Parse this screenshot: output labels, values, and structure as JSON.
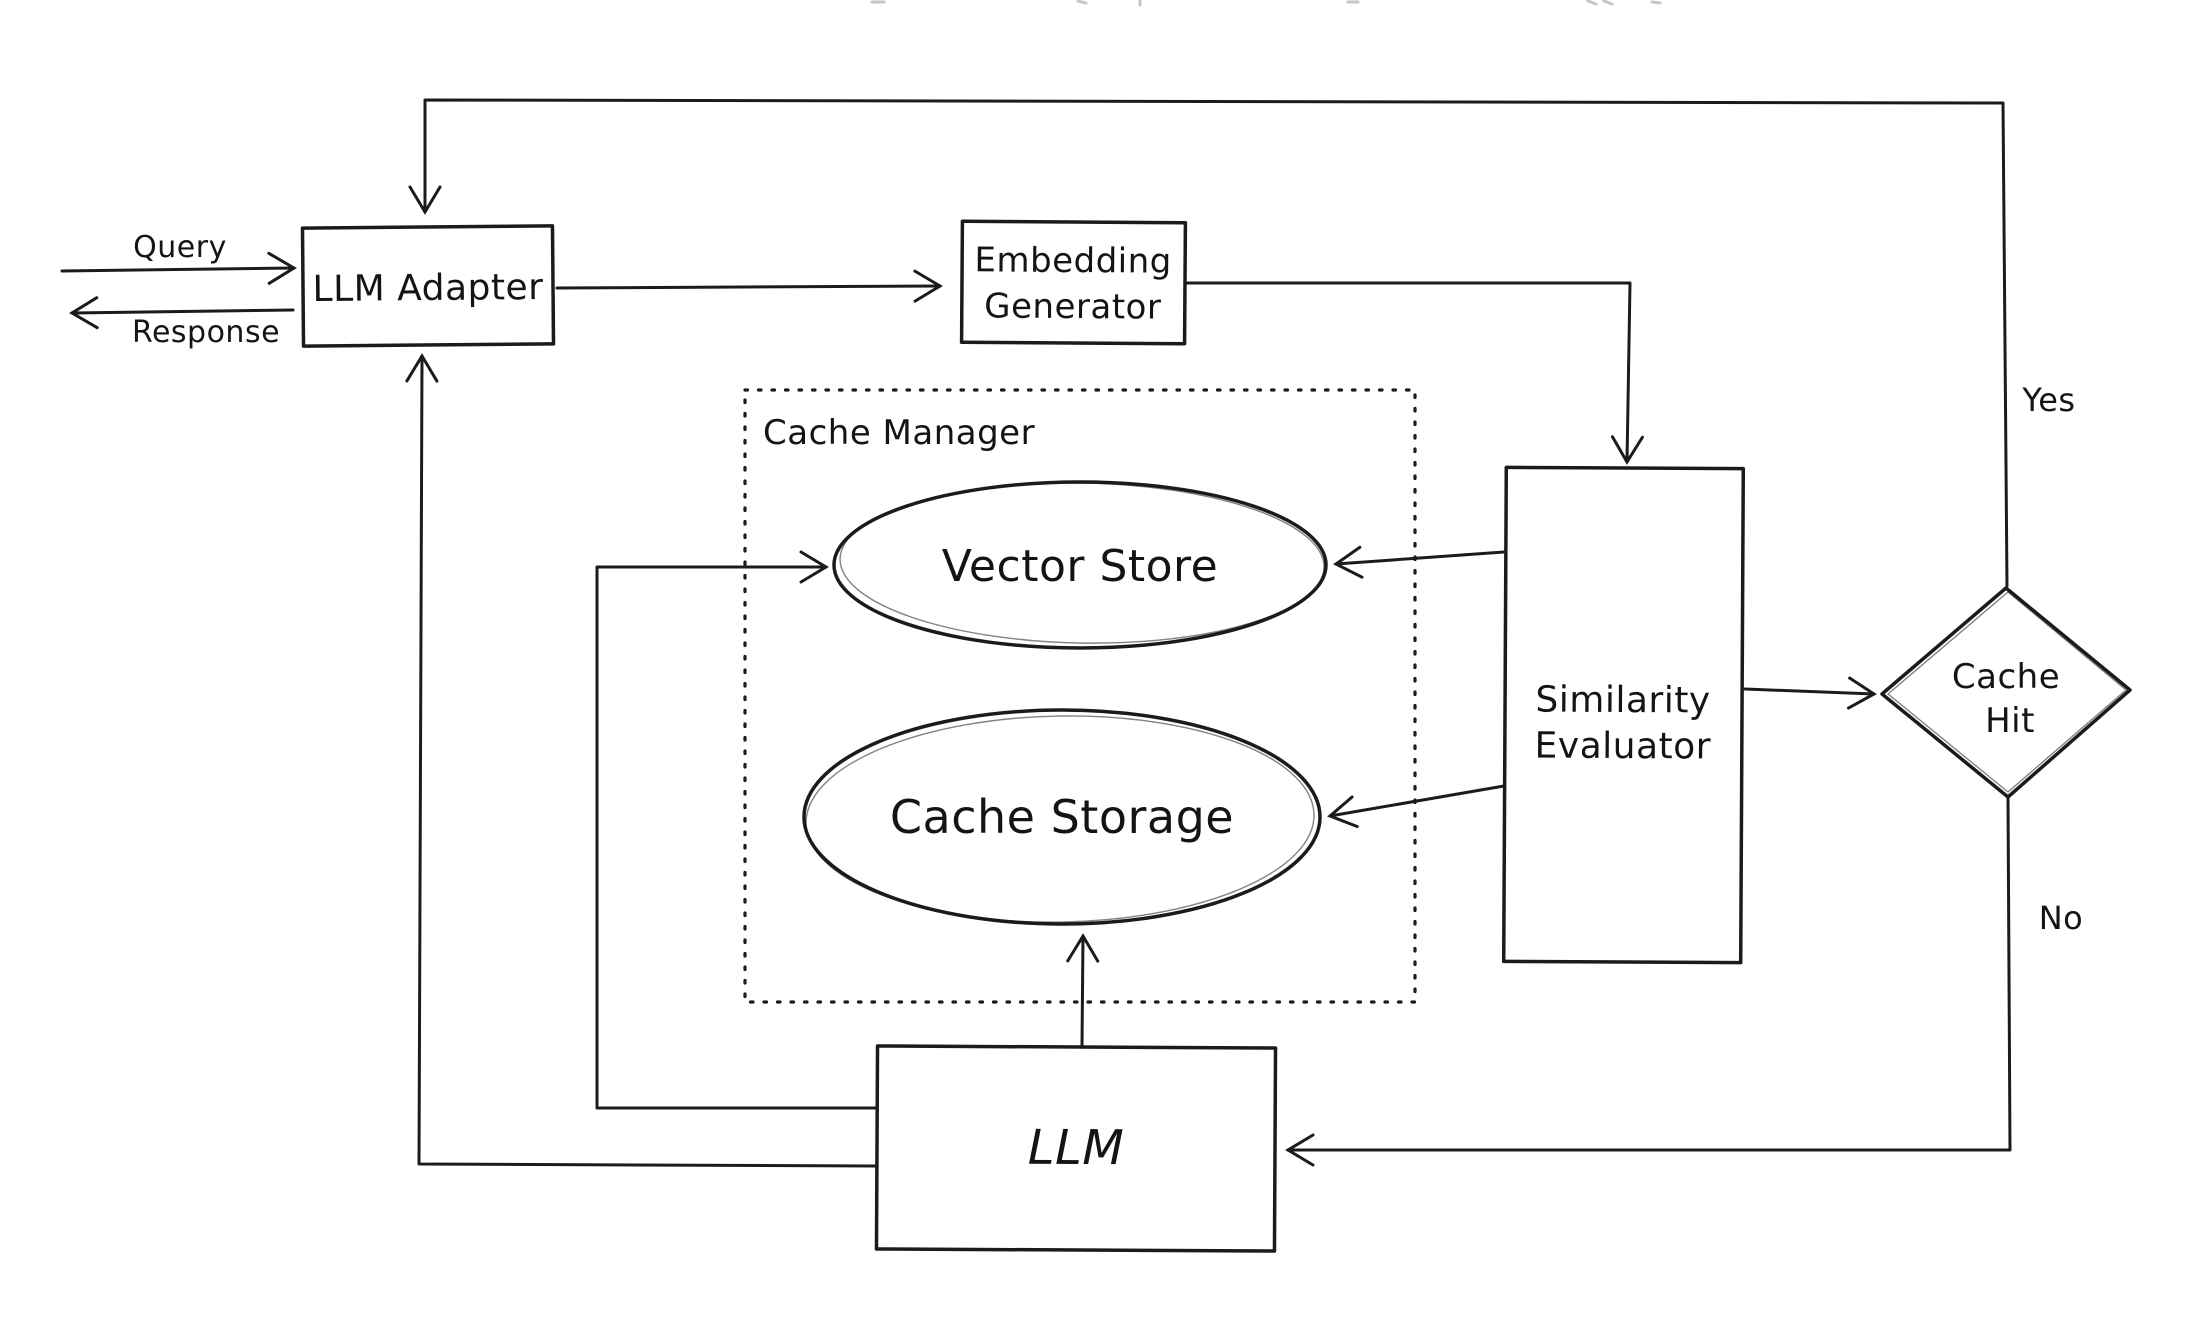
{
  "nodes": {
    "llm_adapter": {
      "label": "LLM Adapter"
    },
    "embedding_generator": {
      "lines": [
        "Embedding",
        "Generator"
      ]
    },
    "cache_manager": {
      "label": "Cache Manager"
    },
    "vector_store": {
      "label": "Vector Store"
    },
    "cache_storage": {
      "label": "Cache Storage"
    },
    "similarity_evaluator": {
      "lines": [
        "Similarity",
        "Evaluator"
      ]
    },
    "cache_hit": {
      "lines": [
        "Cache",
        "Hit"
      ]
    },
    "llm": {
      "label": "LLM"
    }
  },
  "edge_labels": {
    "query": "Query",
    "response": "Response",
    "yes": "Yes",
    "no": "No"
  },
  "colors": {
    "ink": "#1b1b1b",
    "background": "#ffffff"
  }
}
